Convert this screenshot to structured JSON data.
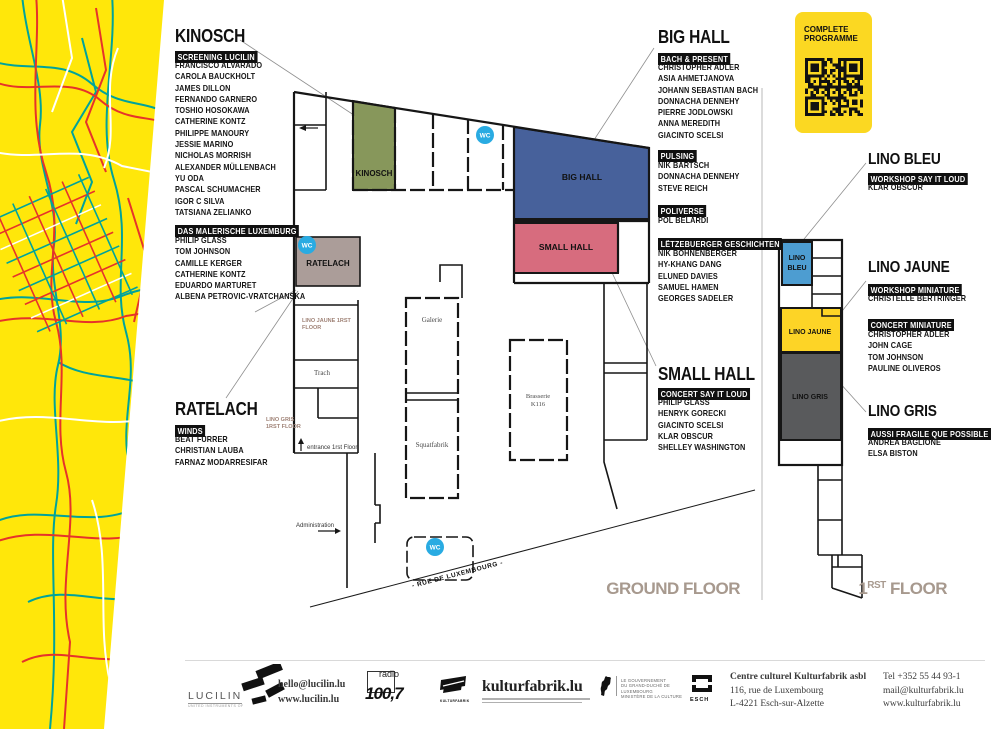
{
  "palette": {
    "map_yellow": "#ffe70a",
    "street_red": "#e6332a",
    "street_teal": "#00a39b",
    "room_kinosch_green": "#87975b",
    "room_bighall_blue": "#47619b",
    "room_smallhall_pink": "#d76c7e",
    "room_ratelach_taupe": "#ab9d99",
    "room_linobleu_blue": "#4d9dd1",
    "room_linojaune_yellow": "#fdd426",
    "room_linogris_gray": "#595a5c",
    "wc_cyan": "#29abe2",
    "card_yellow": "#fbd822",
    "floor_label_gray": "#a7998e"
  },
  "programme_card": {
    "line1": "COMPLETE",
    "line2": "PROGRAMME"
  },
  "sections": {
    "kinosch": {
      "title": "KINOSCH",
      "badge": "SCREENING LUCILIN",
      "artists": [
        "FRANCISCO ALVARADO",
        "CAROLA BAUCKHOLT",
        "JAMES DILLON",
        "FERNANDO GARNERO",
        "TOSHIO HOSOKAWA",
        "CATHERINE KONTZ",
        "PHILIPPE MANOURY",
        "JESSIE MARINO",
        "NICHOLAS MORRISH",
        "ALEXANDER MÜLLENBACH",
        "YU ODA",
        "PASCAL SCHUMACHER",
        "IGOR C SILVA",
        "TATSIANA ZELIANKO"
      ]
    },
    "das_malerische": {
      "badge": "DAS MALERISCHE LUXEMBURG",
      "artists": [
        "PHILIP GLASS",
        "TOM JOHNSON",
        "CAMILLE KERGER",
        "CATHERINE KONTZ",
        "EDUARDO MARTURET",
        "ALBENA PETROVIC-VRATCHANSKA"
      ]
    },
    "ratelach": {
      "title": "RATELACH",
      "badge": "WINDS",
      "artists": [
        "BEAT FURRER",
        "CHRISTIAN LAUBA",
        "FARNAZ MODARRESIFAR"
      ]
    },
    "big_hall": {
      "title": "BIG HALL",
      "badge": "BACH & PRESENT",
      "artists": [
        "CHRISTOPHER ADLER",
        "ASIA AHMETJANOVA",
        "JOHANN SEBASTIAN BACH",
        "DONNACHA DENNEHY",
        "PIERRE JODLOWSKI",
        "ANNA MEREDITH",
        "GIACINTO SCELSI"
      ]
    },
    "pulsing": {
      "badge": "PULSING",
      "artists": [
        "NIK BÄRTSCH",
        "DONNACHA DENNEHY",
        "STEVE REICH"
      ]
    },
    "poliverse": {
      "badge": "POLIVERSE",
      "artists": [
        "POL BELARDI"
      ]
    },
    "letzebuerger": {
      "badge": "LËTZEBUERGER GESCHICHTEN",
      "artists": [
        "NIK BOHNENBERGER",
        "HY-KHANG DANG",
        "ELUNED DAVIES",
        "SAMUEL HAMEN",
        "GEORGES SADELER"
      ]
    },
    "small_hall": {
      "title": "SMALL HALL",
      "badge": "CONCERT SAY IT LOUD",
      "artists": [
        "PHILIP GLASS",
        "HENRYK GORECKI",
        "GIACINTO SCELSI",
        "KLAR OBSCUR",
        "SHELLEY WASHINGTON"
      ]
    },
    "lino_bleu": {
      "title": "LINO BLEU",
      "badge": "WORKSHOP SAY IT LOUD",
      "artists": [
        "KLAR OBSCUR"
      ]
    },
    "lino_jaune": {
      "title": "LINO JAUNE",
      "badge": "WORKSHOP MINIATURE",
      "artists": [
        "CHRISTELLE BERTRINGER"
      ],
      "badge2": "CONCERT MINIATURE",
      "artists2": [
        "CHRISTOPHER ADLER",
        "JOHN CAGE",
        "TOM JOHNSON",
        "PAULINE OLIVEROS"
      ]
    },
    "lino_gris": {
      "title": "LINO GRIS",
      "badge": "AUSSI FRAGILE QUE POSSIBLE",
      "artists": [
        "ANDREA BAGLIONE",
        "ELSA BISTON"
      ]
    }
  },
  "plan": {
    "ground_floor_label": "GROUND FLOOR",
    "first_floor": {
      "num": "1",
      "sup": "RST",
      "rest": " FLOOR"
    },
    "rooms": {
      "kinosch": "KINOSCH",
      "big_hall": "BIG HALL",
      "small_hall": "SMALL HALL",
      "ratelach": "RATELACH",
      "galerie": "Galerie",
      "trach": "Trach",
      "squatfabrik": "Squatfabrik",
      "brasserie_1": "Brasserie",
      "brasserie_2": "K116",
      "lino_bleu_1": "LINO",
      "lino_bleu_2": "BLEU",
      "lino_jaune": "LINO JAUNE",
      "lino_gris": "LINO GRIS"
    },
    "notes": {
      "wc": "WC",
      "entrance": "entrance 1rst Floor",
      "administration": "Administration",
      "street": "- RUE DE LUXEMBOURG -",
      "jaune_ref_1": "LINO JAUNE 1RST",
      "jaune_ref_2": "FLOOR",
      "gris_ref_1": "LINO GRIS",
      "gris_ref_2": "1RST FLOOR"
    }
  },
  "footer": {
    "lucilin_name": "LUCILIN",
    "lucilin_email": "hello@lucilin.lu",
    "lucilin_web": "www.lucilin.lu",
    "radio_top": "radio",
    "radio_big": "100,7",
    "kfab_small": "KULTURFABRIK",
    "kfab_site": "kulturfabrik.lu",
    "gov_lines": [
      "LE GOUVERNEMENT",
      "DU GRAND-DUCHÉ DE LUXEMBOURG",
      "MINISTÈRE DE LA CULTURE"
    ],
    "esch": "ESCH",
    "address": [
      "Centre culturel Kulturfabrik asbl",
      "116, rue de Luxembourg",
      "L-4221 Esch-sur-Alzette"
    ],
    "contact": [
      "Tel +352 55 44 93-1",
      "mail@kulturfabrik.lu",
      "www.kulturfabrik.lu"
    ]
  }
}
